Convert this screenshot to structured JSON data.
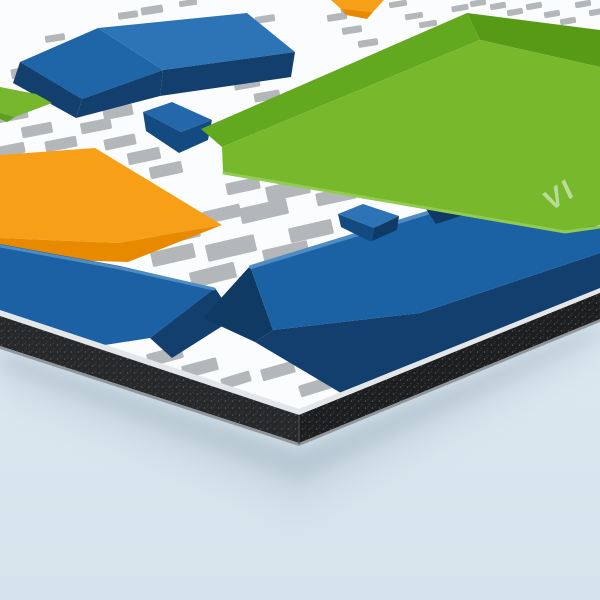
{
  "page": {
    "background_top": "#e4eef4",
    "background_bottom": "#d6e3ec"
  },
  "product": {
    "name": "printed-rigid-panel-mockup",
    "surface_background": "#fbfcfd",
    "panel": {
      "surface_polygon": "0,0 600,0 600,288 299,409 0,310",
      "edge": {
        "top_strip": {
          "points": "0,310 299,409 600,288 600,293 299,415 0,316",
          "fill": "#e3e7e9"
        },
        "core": {
          "points": "0,316 299,415 600,293 600,319 299,443 0,346",
          "fill": "#26282a"
        },
        "core_right": {
          "points": "299,415 600,293 600,319 299,443",
          "fill": "#1c1e20"
        },
        "bottom_strip": {
          "points": "0,346 299,443 600,319 600,322 299,446 0,349",
          "fill": "#8f979c"
        },
        "corner_line": {
          "x1": 299,
          "y1": 416,
          "x2": 299,
          "y2": 444,
          "stroke": "#47494c"
        },
        "speckle_dot1": "#5c5f63",
        "speckle_dot2": "#3f4246"
      },
      "shadows": [
        {
          "points": "0,350 299,448 600,323 600,336 299,482 0,368",
          "fill": "#9db1bf",
          "blur": 9,
          "opacity": 0.5
        },
        {
          "points": "0,355 299,455 600,328 600,350 299,510 0,390",
          "fill": "#aebfcc",
          "blur": 18,
          "opacity": 0.32
        }
      ]
    },
    "artwork": {
      "dash_color": "#b3b7ba",
      "dashes": [
        [
          128,
          15,
          20,
          7,
          -8
        ],
        [
          152,
          10,
          22,
          8,
          -9
        ],
        [
          188,
          3,
          18,
          6,
          -8
        ],
        [
          55,
          38,
          20,
          7,
          -9
        ],
        [
          25,
          72,
          28,
          10,
          -10
        ],
        [
          48,
          86,
          29,
          10,
          -10
        ],
        [
          71,
          100,
          30,
          10,
          -11
        ],
        [
          13,
          115,
          30,
          11,
          -11
        ],
        [
          37,
          130,
          31,
          11,
          -11
        ],
        [
          61,
          144,
          32,
          11,
          -11
        ],
        [
          10,
          150,
          30,
          11,
          -11
        ],
        [
          118,
          112,
          30,
          11,
          -11
        ],
        [
          96,
          126,
          31,
          11,
          -11
        ],
        [
          120,
          142,
          32,
          11,
          -12
        ],
        [
          144,
          156,
          33,
          12,
          -12
        ],
        [
          166,
          170,
          33,
          12,
          -12
        ],
        [
          247,
          84,
          26,
          9,
          -10
        ],
        [
          267,
          96,
          26,
          9,
          -10
        ],
        [
          265,
          19,
          20,
          7,
          -9
        ],
        [
          350,
          8,
          19,
          7,
          -9
        ],
        [
          337,
          17,
          20,
          7,
          -9
        ],
        [
          352,
          30,
          20,
          7,
          -9
        ],
        [
          368,
          43,
          20,
          7,
          -9
        ],
        [
          398,
          4,
          18,
          6,
          -9
        ],
        [
          414,
          16,
          18,
          6,
          -9
        ],
        [
          428,
          24,
          18,
          6,
          -9
        ],
        [
          460,
          8,
          17,
          6,
          -10
        ],
        [
          478,
          3,
          16,
          6,
          -10
        ],
        [
          498,
          6,
          16,
          6,
          -10
        ],
        [
          515,
          12,
          16,
          6,
          -10
        ],
        [
          534,
          6,
          16,
          6,
          -10
        ],
        [
          552,
          14,
          16,
          6,
          -10
        ],
        [
          568,
          21,
          16,
          6,
          -10
        ],
        [
          583,
          4,
          16,
          6,
          -10
        ],
        [
          597,
          12,
          16,
          6,
          -10
        ],
        [
          243,
          186,
          34,
          12,
          -12
        ],
        [
          288,
          190,
          44,
          15,
          -12
        ],
        [
          336,
          196,
          40,
          13,
          -12
        ],
        [
          222,
          214,
          38,
          13,
          -13
        ],
        [
          264,
          211,
          48,
          16,
          -13
        ],
        [
          311,
          231,
          44,
          15,
          -13
        ],
        [
          180,
          234,
          40,
          14,
          -13
        ],
        [
          231,
          248,
          50,
          17,
          -13
        ],
        [
          286,
          253,
          46,
          16,
          -13
        ],
        [
          173,
          255,
          44,
          15,
          -13
        ],
        [
          213,
          275,
          46,
          16,
          -14
        ],
        [
          165,
          356,
          36,
          13,
          -15
        ],
        [
          200,
          368,
          36,
          13,
          -15
        ],
        [
          236,
          380,
          30,
          11,
          -17
        ],
        [
          278,
          371,
          34,
          12,
          -16
        ],
        [
          315,
          387,
          32,
          12,
          -17
        ]
      ],
      "shapes": [
        {
          "name": "blue-box-topleft-left-face",
          "points": "20,62 98,28 163,70 82,99",
          "fill": "#1f66a8"
        },
        {
          "name": "blue-box-topleft-top-face",
          "points": "98,28 247,13 295,52 163,70",
          "fill": "#2d74b6"
        },
        {
          "name": "blue-box-topleft-front-1",
          "points": "20,62 82,99 76,118 13,83",
          "fill": "#123f6e"
        },
        {
          "name": "blue-box-topleft-front-2",
          "points": "82,99 163,70 160,96 76,118",
          "fill": "#123f6e"
        },
        {
          "name": "blue-box-topleft-front-3",
          "points": "163,70 295,52 291,77 160,96",
          "fill": "#123f6e"
        },
        {
          "name": "green-chip-left",
          "points": "0,87 36,94 52,103 15,117 0,113",
          "fill": "#76b72d"
        },
        {
          "name": "green-chip-left-bevel",
          "points": "0,113 15,117 7,122 0,119",
          "fill": "#5da021"
        },
        {
          "name": "orange-fragment-top",
          "points": "331,0 384,0 373,12 341,9",
          "fill": "#f79f17"
        },
        {
          "name": "orange-fragment-top-bevel",
          "points": "341,9 373,12 367,19 346,15",
          "fill": "#e88a00"
        },
        {
          "name": "blue-box-upper-top-face",
          "points": "143,112 172,102 212,120 181,132",
          "fill": "#2468ab"
        },
        {
          "name": "blue-box-upper-front-face",
          "points": "143,112 181,132 212,120 208,140 179,153 146,131",
          "fill": "#134a80"
        },
        {
          "name": "orange-box-top-face",
          "points": "0,155 95,148 222,225 118,243 0,238",
          "fill": "#f79f17"
        },
        {
          "name": "orange-box-front-face",
          "points": "0,238 118,243 222,225 128,262 0,258",
          "fill": "#e88a00"
        },
        {
          "name": "blue-slab-left-main",
          "points": "0,244 120,266 215,288 150,338 60,352 0,332",
          "fill": "#1b61a3"
        },
        {
          "name": "blue-slab-left-fold",
          "points": "215,288 235,318 172,358 150,338",
          "fill": "#123f6e"
        },
        {
          "name": "blue-slab-left-bevel",
          "type": "stroke",
          "points": "0,246 120,268 214,289",
          "stroke": "#4e8cc4",
          "width": 3
        },
        {
          "name": "blue-slab-center-left-face",
          "points": "250,266 273,330 255,342 203,318",
          "fill": "#0f3a63"
        },
        {
          "name": "blue-slab-center-main",
          "points": "250,266 428,212 600,226 600,253 420,313 273,330",
          "fill": "#1b62a5"
        },
        {
          "name": "blue-slab-center-front",
          "points": "273,330 420,313 600,253 600,290 341,393 255,342",
          "fill": "#123f6e"
        },
        {
          "name": "blue-slab-center-bevel",
          "type": "stroke",
          "points": "251,267 427,213",
          "stroke": "#4e8cc4",
          "width": 4
        },
        {
          "name": "blue-wedge-under-green",
          "points": "424,206 470,213 436,224",
          "fill": "#0f3a63"
        },
        {
          "name": "blue-box-small-top-face",
          "points": "338,214 363,204 399,216 374,228",
          "fill": "#2d74b6"
        },
        {
          "name": "blue-box-small-front-face",
          "points": "338,214 374,228 371,242 341,227",
          "fill": "#134a80"
        },
        {
          "name": "blue-box-small-right-face",
          "points": "374,228 399,216 397,230 372,241",
          "fill": "#0f3a63"
        },
        {
          "name": "green-slab-bevel-topleft",
          "points": "201,129 467,13 480,40 222,147",
          "fill": "#62a91f"
        },
        {
          "name": "green-slab-bevel-topright",
          "points": "467,13 600,30 600,67 480,40",
          "fill": "#569a16"
        },
        {
          "name": "green-slab-main",
          "points": "222,147 480,40 600,67 600,225 565,231 223,172",
          "fill": "#77b82d"
        },
        {
          "name": "green-slab-bevel-bottom",
          "type": "stroke",
          "points": "224,173 565,232 600,227",
          "stroke": "#92cb4f",
          "width": 3
        }
      ],
      "label": {
        "text": "VI",
        "x": 550,
        "y": 212,
        "rotate": -33,
        "skew": -8,
        "size": 28,
        "letter_spacing": 3,
        "fill": "#ffffff",
        "opacity": 0.5
      }
    }
  }
}
